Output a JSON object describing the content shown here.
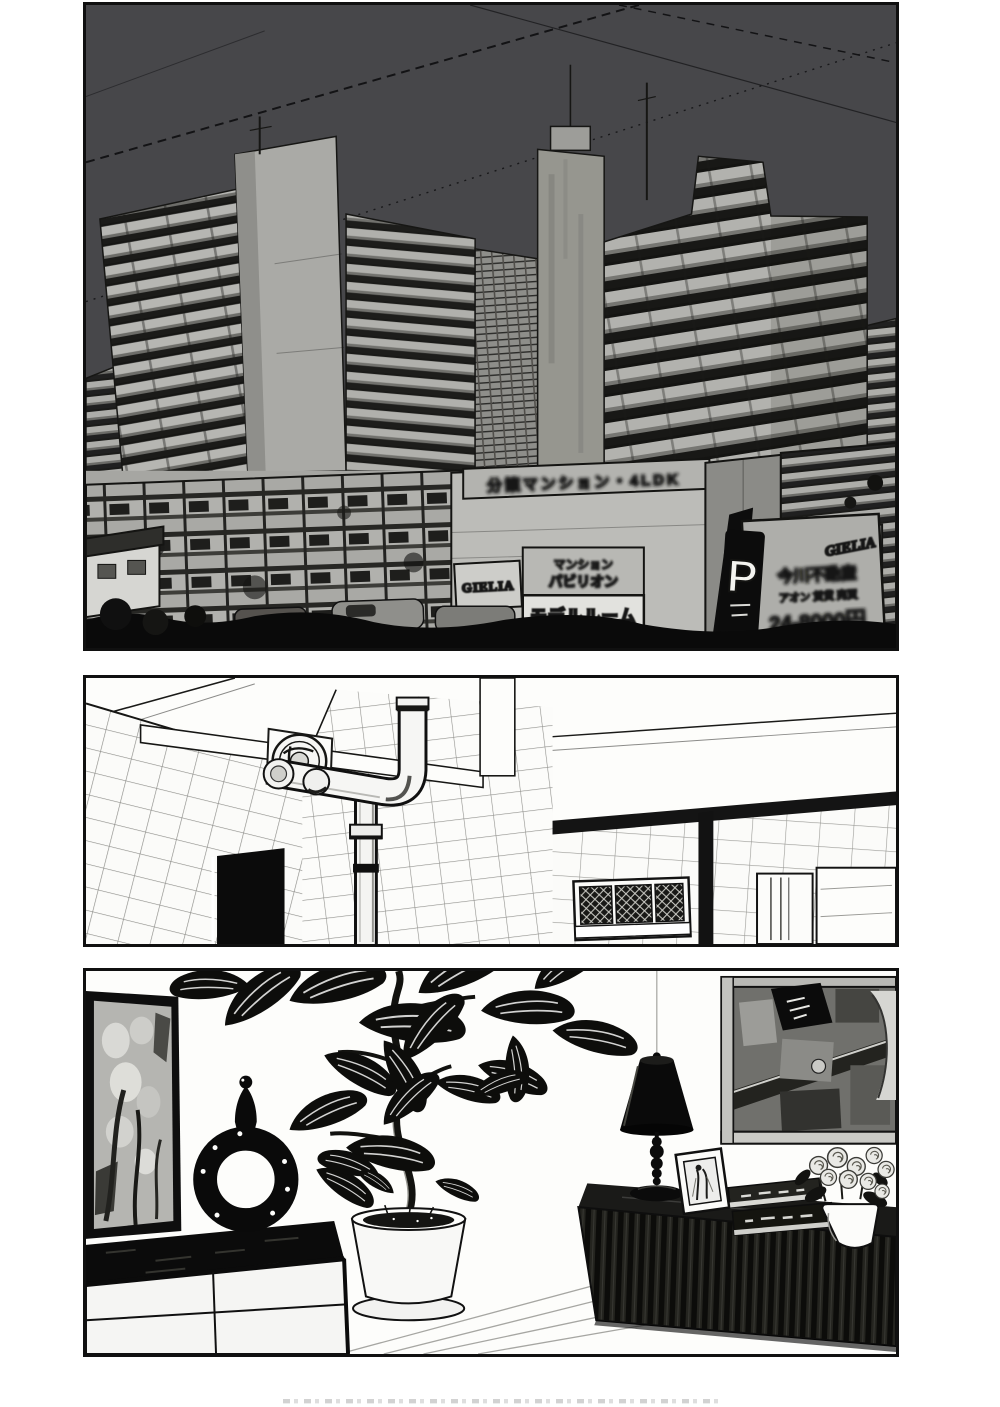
{
  "page": {
    "background": "#ffffff",
    "ink": "#101010"
  },
  "panel1": {
    "colors": {
      "sky": "#47474a",
      "building": "#a4a4a0",
      "billboard": "#aeaeaa"
    },
    "signs": {
      "rooftop_banner_blurred": "分譲マンション・4LDK",
      "gielia_small": "GIELIA",
      "board_upper_line1_blurred": "マンション",
      "board_upper_line2_blurred": "パビリオン",
      "model_room": "モデルルーム",
      "parking": "P",
      "billboard_logo": "GIELIA",
      "billboard_line1_blurred": "今川不動産",
      "billboard_line2_blurred": "アオン 賃貸 売買",
      "billboard_line3_blurred": "24-8000円"
    }
  },
  "panel2": {
    "colors": {
      "tile_line": "#8e8e8a"
    }
  },
  "panel3": {
    "colors": {
      "wood": "#1c1c1a"
    }
  }
}
